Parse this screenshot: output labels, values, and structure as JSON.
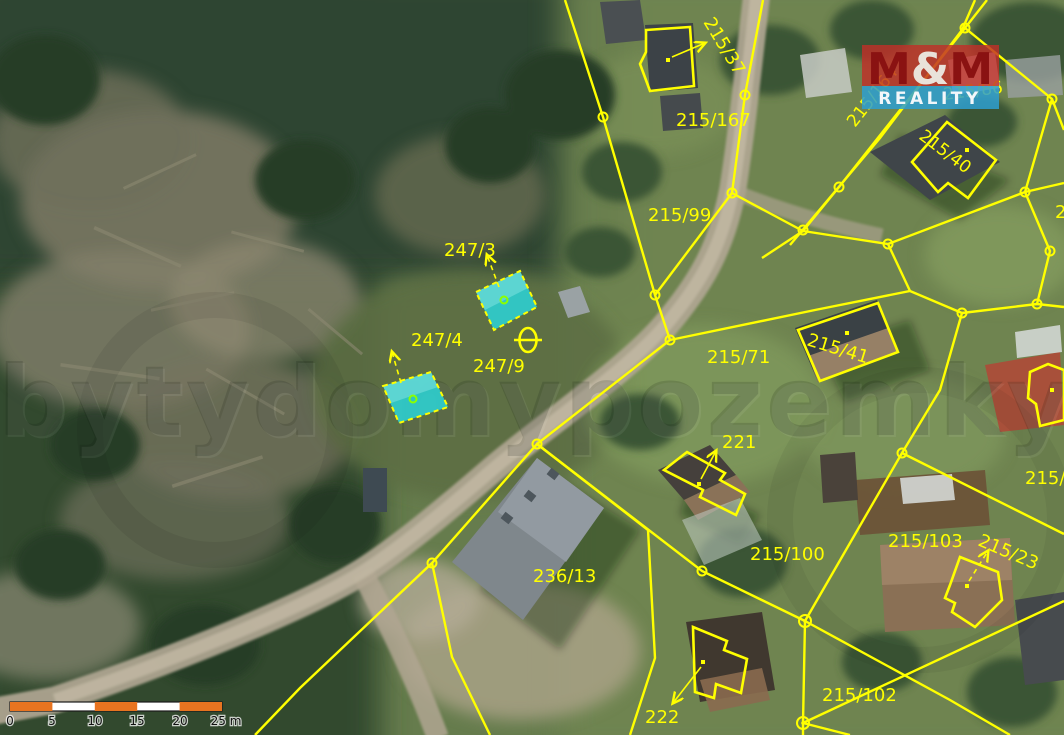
{
  "map": {
    "type": "aerial-cadastral-map",
    "parcel_labels": [
      {
        "id": 0,
        "text": "215/37"
      },
      {
        "id": 1,
        "text": "215/167"
      },
      {
        "id": 2,
        "text": "215/99"
      },
      {
        "id": 3,
        "text": "215/164"
      },
      {
        "id": 4,
        "text": "215/86"
      },
      {
        "id": 5,
        "text": "215/40"
      },
      {
        "id": 6,
        "text": "247/3"
      },
      {
        "id": 7,
        "text": "247/4"
      },
      {
        "id": 8,
        "text": "247/9"
      },
      {
        "id": 9,
        "text": "215/71"
      },
      {
        "id": 10,
        "text": "215/41"
      },
      {
        "id": 11,
        "text": "221"
      },
      {
        "id": 12,
        "text": "215/100"
      },
      {
        "id": 13,
        "text": "236/13"
      },
      {
        "id": 14,
        "text": "215/103"
      },
      {
        "id": 15,
        "text": "215/23"
      },
      {
        "id": 16,
        "text": "215/102"
      },
      {
        "id": 17,
        "text": "222"
      },
      {
        "id": 18,
        "text": "215/9"
      },
      {
        "id": 19,
        "text": "2"
      }
    ],
    "highlighted_parcels": [
      "247/3",
      "247/4"
    ],
    "symbols": [
      {
        "name": "theta-map-symbol",
        "glyph": "θ"
      },
      {
        "name": "parcel-node-marker",
        "glyph": "○"
      }
    ]
  },
  "watermark": {
    "text": "bytydomypozemky"
  },
  "logo": {
    "m1": "M",
    "amp": "&",
    "m2": "M",
    "line2": "REALITY"
  },
  "scale_bar": {
    "labels": [
      "0",
      "5",
      "10",
      "15",
      "20",
      "25 m"
    ],
    "segments": 5,
    "segment_meters": 5
  },
  "colors": {
    "boundary_yellow": "#ffff00",
    "highlight_cyan": "#2fc9c9",
    "logo_red": "#c03028",
    "logo_blue": "#2e9fd0",
    "scale_orange": "#e87420"
  }
}
